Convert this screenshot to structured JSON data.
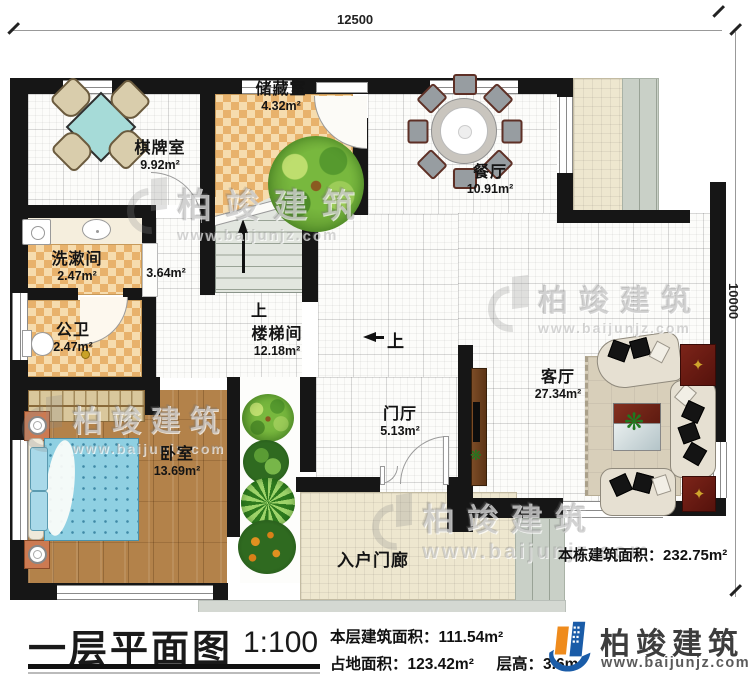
{
  "dimensions": {
    "top": "12500",
    "right": "10000"
  },
  "rooms": {
    "chess": {
      "name": "棋牌室",
      "area": "9.92m²"
    },
    "storage": {
      "name": "储藏室",
      "area": "4.32m²"
    },
    "dining": {
      "name": "餐厅",
      "area": "10.91m²"
    },
    "wash": {
      "name": "洗漱间",
      "area": "2.47m²"
    },
    "wc": {
      "name": "公卫",
      "area": "2.47m²"
    },
    "hall_area": "3.64m²",
    "stairhall": {
      "name": "楼梯间",
      "area": "12.18m²"
    },
    "foyer": {
      "name": "门厅",
      "area": "5.13m²"
    },
    "living": {
      "name": "客厅",
      "area": "27.34m²"
    },
    "bedroom": {
      "name": "卧室",
      "area": "13.69m²"
    },
    "porch": {
      "name": "入户门廊"
    }
  },
  "annotations": {
    "up": "上",
    "total_label": "本栋建筑面积：",
    "total_value": "232.75m²"
  },
  "footer": {
    "plan_title": "一层平面图",
    "scale": "1:100",
    "floor_area_label": "本层建筑面积：",
    "floor_area_value": "111.54m²",
    "land_area_label": "占地面积：",
    "land_area_value": "123.42m²",
    "height_label": "层高：",
    "height_value": "3.6m",
    "brand": "柏竣建筑",
    "website": "www.baijunjz.com"
  },
  "watermark": {
    "brand": "柏竣建筑",
    "website": "www.baijunjz.com"
  }
}
